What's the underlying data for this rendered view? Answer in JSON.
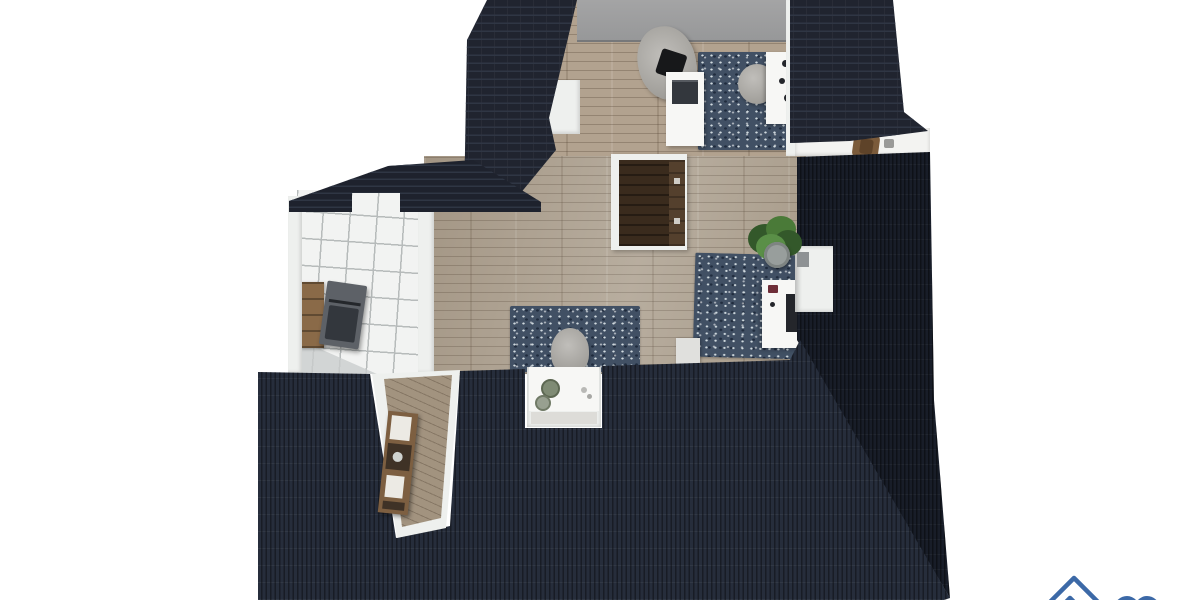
{
  "scene": {
    "type": "3d-floor-plan-render",
    "view": "top-down bird's-eye rendering of a furnished attic storey surrounded by dark tiled roof planes",
    "background": "#ffffff"
  },
  "colors": {
    "bg": "#ffffff",
    "roof_top": "#20242f",
    "roof_band": "#1e222d",
    "roof_bottom": "#262d3b",
    "roof_right": "#181d28",
    "roof_line": "#2f3644",
    "wood_room": "#b2a28f",
    "wood_center": "#aca08f",
    "wood_hall": "#a2937f",
    "wall_white": "#eef0ee",
    "wall_shadow": "#d0d2d0",
    "wall_gray": "#979899",
    "tile": "#f2f3f2",
    "tile_grout": "#b7bbbb",
    "tile_shade": "#c9cdcd",
    "rug": "#415064",
    "rug_light": "#cfd9de",
    "rug_dark": "#202c3e",
    "stair": "#3a2b1d",
    "stair_light": "#54402d",
    "shelf": "#7d5f41",
    "shelf_dark": "#3f3226",
    "cabinet": "#8a6a48",
    "appliance": "#5d6167",
    "appliance_dark": "#33373d",
    "chair_light": "#c0beba",
    "chair_mid": "#95938e",
    "chair_dark": "#474b50",
    "desk_white": "#f7f7f5",
    "monitor": "#24262b",
    "accent_red": "#6e2e38",
    "plant": "#4a7a38",
    "plant_dark": "#33582a",
    "pot": "#989e9c",
    "terrace": "#f3f3f1",
    "basin": "#7f8b74",
    "logo": "#3c69a7"
  },
  "inventory": {
    "rooms": [
      "attic-room",
      "landing",
      "kitchenette",
      "hallway",
      "washbasin-niche",
      "balcony"
    ],
    "furniture": [
      "armchair",
      "throw-pillow",
      "tv-cabinet",
      "tv",
      "area-rug",
      "desk-chair",
      "wall-desk",
      "staircase",
      "potted-plant",
      "office-desk",
      "monitor",
      "office-chair",
      "lounge-chair",
      "washbasin-cabinet",
      "hallway-shelf",
      "kitchen-appliance",
      "kitchen-cabinet",
      "balcony-chair"
    ]
  },
  "watermark": {
    "icons": [
      "house-icon",
      "heart-icon"
    ],
    "color": "#3c69a7"
  }
}
